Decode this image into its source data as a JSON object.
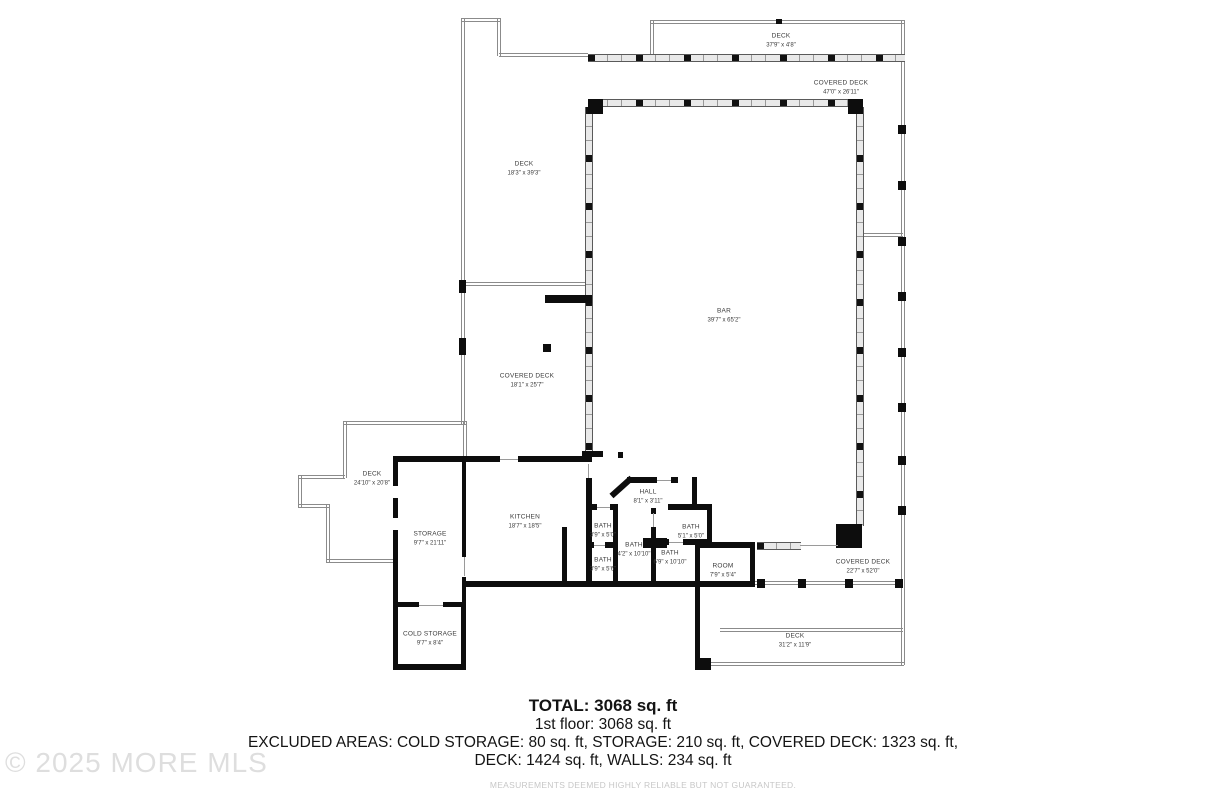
{
  "watermark": {
    "text": "© 2025 MORE MLS"
  },
  "rooms": [
    {
      "name": "DECK",
      "dims": "37'9\" x 4'8\""
    },
    {
      "name": "COVERED DECK",
      "dims": "47'0\" x 26'11\""
    },
    {
      "name": "DECK",
      "dims": "18'3\" x 39'3\""
    },
    {
      "name": "BAR",
      "dims": "39'7\" x 65'2\""
    },
    {
      "name": "COVERED DECK",
      "dims": "18'1\" x 25'7\""
    },
    {
      "name": "DECK",
      "dims": "24'10\" x 20'8\""
    },
    {
      "name": "STORAGE",
      "dims": "9'7\" x 21'11\""
    },
    {
      "name": "KITCHEN",
      "dims": "18'7\" x 18'5\""
    },
    {
      "name": "HALL",
      "dims": "8'1\" x 3'11\""
    },
    {
      "name": "BATH",
      "dims": "3'9\" x 5'0\""
    },
    {
      "name": "BATH",
      "dims": "5'1\" x 5'0\""
    },
    {
      "name": "BATH",
      "dims": "4'2\" x 10'10\""
    },
    {
      "name": "BATH",
      "dims": "3'9\" x 5'6\""
    },
    {
      "name": "BATH",
      "dims": "6'9\" x 10'10\""
    },
    {
      "name": "ROOM",
      "dims": "7'9\" x 5'4\""
    },
    {
      "name": "COVERED DECK",
      "dims": "22'7\" x 52'0\""
    },
    {
      "name": "DECK",
      "dims": "31'2\" x 11'9\""
    },
    {
      "name": "COLD STORAGE",
      "dims": "9'7\" x 8'4\""
    }
  ],
  "footer": {
    "total": "TOTAL: 3068 sq. ft",
    "floor": "1st floor: 3068 sq. ft",
    "excluded_line1": "EXCLUDED AREAS: COLD STORAGE: 80 sq. ft, STORAGE: 210 sq. ft, COVERED DECK: 1323 sq. ft,",
    "excluded_line2": "DECK: 1424 sq. ft, WALLS: 234 sq. ft",
    "disclaimer": "MEASUREMENTS DEEMED HIGHLY RELIABLE BUT NOT GUARANTEED."
  }
}
